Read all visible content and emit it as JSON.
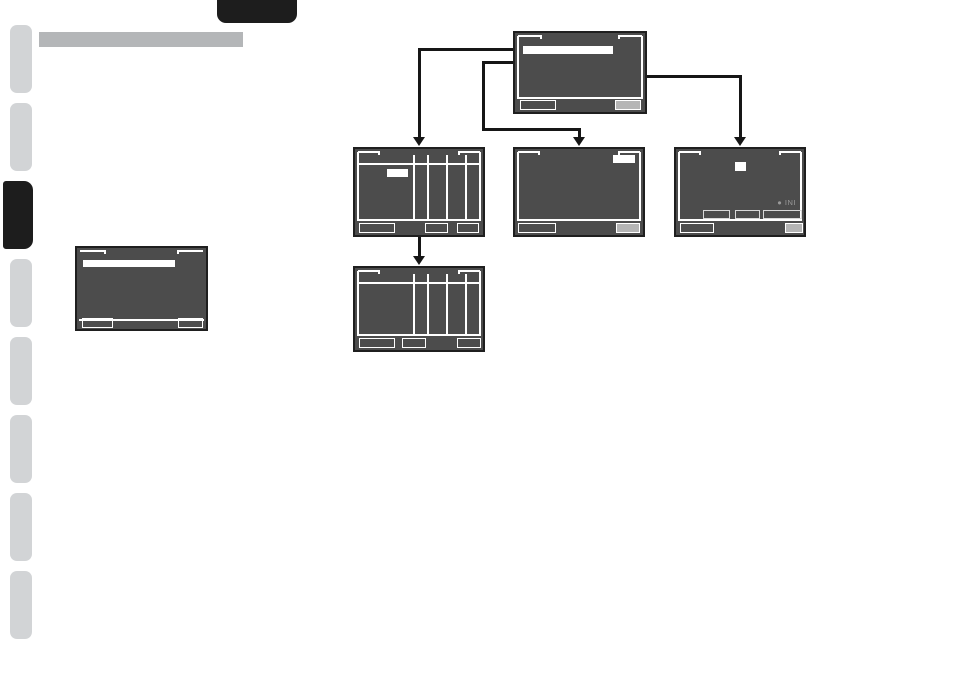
{
  "page": {
    "background": "#ffffff"
  },
  "sidebar": {
    "tab_count": 8,
    "active_tab_position": 3,
    "tab_color": "#d2d4d6",
    "active_tab_color": "#1d1d1d"
  },
  "header": {
    "corner_tab_color": "#1d1d1d",
    "title_bar_color": "#b4b6b8"
  },
  "diagram": {
    "screen_fill": "#4c4c4c",
    "screen_border": "#1f1f1f",
    "connector_color": "#161616",
    "highlight_color": "#ffffff",
    "filled_button_color": "#b5b5b5",
    "init_label": "● INI",
    "screens": [
      {
        "id": "root-menu-screen",
        "row": 1,
        "features": [
          "selection-bar",
          "bottom-left-outline-button",
          "bottom-right-filled-button"
        ]
      },
      {
        "id": "table-screen-with-highlight",
        "row": 2,
        "features": [
          "column-grid",
          "highlight-cell",
          "three-bottom-buttons"
        ]
      },
      {
        "id": "blank-screen-highlight-right",
        "row": 2,
        "features": [
          "highlight-top-right",
          "bottom-left-outline-button",
          "bottom-right-filled-button"
        ]
      },
      {
        "id": "status-screen-init",
        "row": 2,
        "features": [
          "highlight-top-center",
          "init-label",
          "three-inner-buttons",
          "bottom-buttons"
        ]
      },
      {
        "id": "table-screen-plain",
        "row": 3,
        "features": [
          "column-grid",
          "three-bottom-buttons"
        ]
      },
      {
        "id": "standalone-menu-screen",
        "row": 0,
        "features": [
          "selection-bar",
          "two-bottom-outline-buttons"
        ]
      }
    ]
  }
}
